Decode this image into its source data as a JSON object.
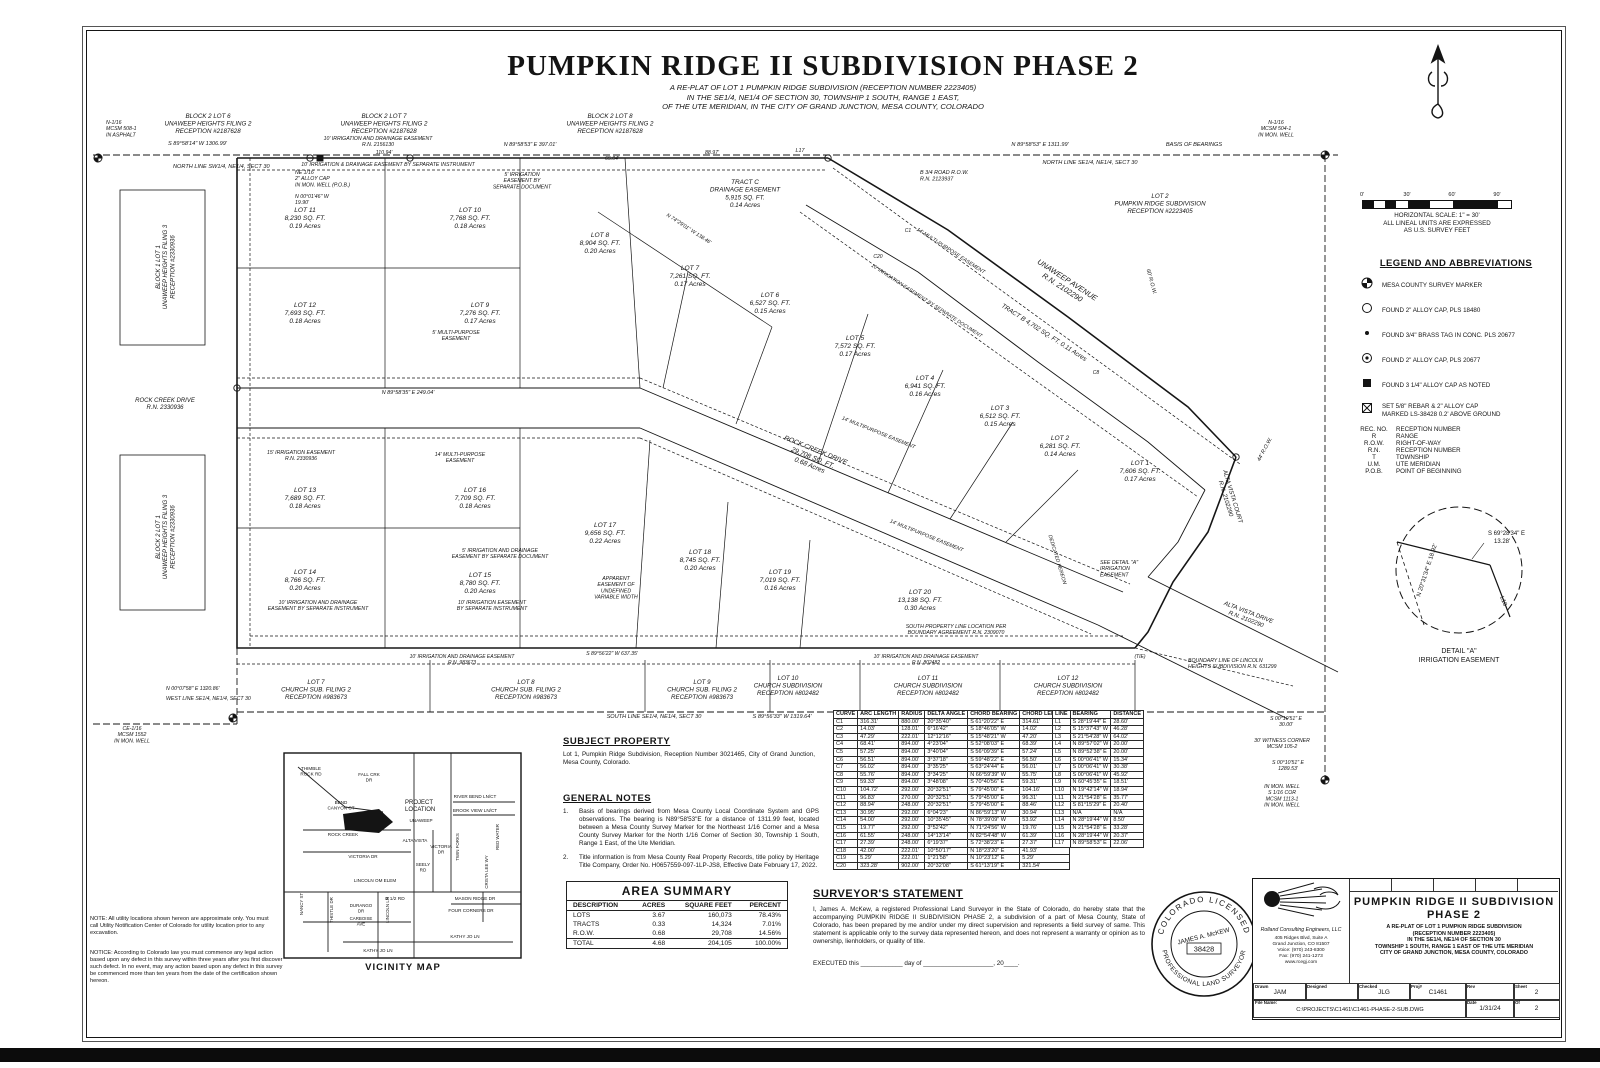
{
  "title": {
    "main": "PUMPKIN RIDGE II SUBDIVISION PHASE 2",
    "sub1": "A RE-PLAT OF LOT 1 PUMPKIN RIDGE SUBDIVISION (RECEPTION NUMBER 2223405)",
    "sub2": "IN THE SE1/4, NE1/4 OF SECTION 30, TOWNSHIP 1 SOUTH, RANGE 1 EAST,",
    "sub3": "OF THE UTE MERIDIAN, IN THE CITY OF GRAND JUNCTION, MESA COUNTY, COLORADO"
  },
  "scale": {
    "ticks": [
      "0'",
      "30'",
      "60'",
      "90'"
    ],
    "cap1": "HORIZONTAL SCALE: 1\" = 30'",
    "cap2": "ALL LINEAL UNITS ARE EXPRESSED",
    "cap3": "AS U.S. SURVEY FEET"
  },
  "legend": {
    "heading": "LEGEND AND ABBREVIATIONS",
    "symbols": [
      {
        "sym": "mcsm",
        "label": "MESA COUNTY SURVEY MARKER"
      },
      {
        "sym": "circle",
        "label": "FOUND 2\" ALLOY CAP, PLS 18480"
      },
      {
        "sym": "dot",
        "label": "FOUND 3/4\" BRASS TAG IN CONC. PLS 20677"
      },
      {
        "sym": "circle-dot",
        "label": "FOUND 2\" ALLOY CAP, PLS 20677"
      },
      {
        "sym": "square",
        "label": "FOUND 3 1/4\" ALLOY CAP AS NOTED"
      },
      {
        "sym": "boxx",
        "label": "SET 5/8\" REBAR & 2\" ALLOY CAP\nMARKED LS-38428 0.2' ABOVE GROUND"
      }
    ],
    "abbreviations": [
      {
        "k": "REC. NO.",
        "v": "RECEPTION NUMBER"
      },
      {
        "k": "R",
        "v": "RANGE"
      },
      {
        "k": "R.O.W.",
        "v": "RIGHT-OF-WAY"
      },
      {
        "k": "R.N.",
        "v": "RECEPTION NUMBER"
      },
      {
        "k": "T",
        "v": "TOWNSHIP"
      },
      {
        "k": "U.M.",
        "v": "UTE MERIDIAN"
      },
      {
        "k": "P.O.B.",
        "v": "POINT OF BEGINNING"
      }
    ]
  },
  "detail_a": {
    "b1a": "S 69°28'34\" E",
    "b1b": "13.28'",
    "b2": "N 20°31'34\" E  18.92'",
    "tag": "L10",
    "cap1": "DETAIL \"A\"",
    "cap2": "IRRIGATION EASEMENT"
  },
  "plat": {
    "lots": [
      {
        "name": "LOT 1",
        "sqft": "7,606 SQ. FT.",
        "acres": "0.17 Acres"
      },
      {
        "name": "LOT 2",
        "sqft": "6,281 SQ. FT.",
        "acres": "0.14 Acres"
      },
      {
        "name": "LOT 3",
        "sqft": "6,512 SQ. FT.",
        "acres": "0.15 Acres"
      },
      {
        "name": "LOT 4",
        "sqft": "6,941 SQ. FT.",
        "acres": "0.16 Acres"
      },
      {
        "name": "LOT 5",
        "sqft": "7,572 SQ. FT.",
        "acres": "0.17 Acres"
      },
      {
        "name": "LOT 6",
        "sqft": "6,527 SQ. FT.",
        "acres": "0.15 Acres"
      },
      {
        "name": "LOT 7",
        "sqft": "7,261 SQ. FT.",
        "acres": "0.17 Acres"
      },
      {
        "name": "LOT 8",
        "sqft": "8,904 SQ. FT.",
        "acres": "0.20 Acres"
      },
      {
        "name": "LOT 9",
        "sqft": "7,276 SQ. FT.",
        "acres": "0.17 Acres"
      },
      {
        "name": "LOT 10",
        "sqft": "7,768 SQ. FT.",
        "acres": "0.18 Acres"
      },
      {
        "name": "LOT 11",
        "sqft": "8,230 SQ. FT.",
        "acres": "0.19 Acres"
      },
      {
        "name": "LOT 12",
        "sqft": "7,693 SQ. FT.",
        "acres": "0.18 Acres"
      },
      {
        "name": "LOT 13",
        "sqft": "7,689 SQ. FT.",
        "acres": "0.18 Acres"
      },
      {
        "name": "LOT 14",
        "sqft": "8,766 SQ. FT.",
        "acres": "0.20 Acres"
      },
      {
        "name": "LOT 15",
        "sqft": "8,780 SQ. FT.",
        "acres": "0.20 Acres"
      },
      {
        "name": "LOT 16",
        "sqft": "7,709 SQ. FT.",
        "acres": "0.18 Acres"
      },
      {
        "name": "LOT 17",
        "sqft": "9,656 SQ. FT.",
        "acres": "0.22 Acres"
      },
      {
        "name": "LOT 18",
        "sqft": "8,745 SQ. FT.",
        "acres": "0.20 Acres"
      },
      {
        "name": "LOT 19",
        "sqft": "7,019 SQ. FT.",
        "acres": "0.16 Acres"
      },
      {
        "name": "LOT 20",
        "sqft": "13,138 SQ. FT.",
        "acres": "0.30 Acres"
      }
    ],
    "annotations": [
      "N-1/16\nMCSM 508-1\nIN ASPHALT",
      "S 89°58'14\" W  1306.99'",
      "NORTH LINE SW1/4, NE1/4, SECT 30",
      "BLOCK 2 LOT 6\nUNAWEEP HEIGHTS FILING 2\nRECEPTION #2187628",
      "BLOCK 2 LOT 7\nUNAWEEP HEIGHTS FILING 2\nRECEPTION #2187628",
      "BLOCK 2 LOT 8\nUNAWEEP HEIGHTS FILING 2\nRECEPTION #2187628",
      "10' IRRIGATION AND DRAINAGE EASEMENT\nR.N. 2156130",
      "N 89°58'53\" E  397.01'",
      "10' IRRIGATION & DRAINAGE EASEMENT  BY SEPARATE INSTRUMENT",
      "NE 1/16\n2\" ALLOY CAP\nIN MON. WELL (P.O.B.)",
      "N 00°01'46\" W\n19.90'",
      "N 89°58'53\" E  1311.99'",
      "BASIS OF BEARINGS",
      "NORTH LINE SE1/4, NE1/4, SECT 30",
      "N-1/16\nMCSM 504-1\nIN MON. WELL",
      "B 3/4 ROAD R.O.W.\nR.N. 2123937",
      "LOT 2\nPUMPKIN RIDGE SUBDIVISION\nRECEPTION #2223405",
      "UNAWEEP AVENUE\nR.N. 2102290",
      "TRACT B    4,702 SQ. FT.    0.11 Acres",
      "60' R.O.W.",
      "14' MULTI-PURPOSE EASEMENT",
      "10' IRRIGATION EASEMENT  BY SEPARATE DOCUMENT",
      "ROCK CREEK DRIVE\nR.N. 2330936",
      "N 89°58'35\" E  249.04'",
      "ROCK CREEK DRIVE\n29,708 SQ. FT.\n0.68 Acres",
      "ALTA VISTA COURT\nR.N. 2102290",
      "ALTA VISTA DRIVE\nR.N. 2102290",
      "14' MULTIPURPOSE EASEMENT",
      "14' MULTIPURPOSE EASEMENT",
      "15' IRRIGATION EASEMENT\nR.N. 2330936",
      "14' MULTI-PURPOSE\nEASEMENT",
      "5' MULTI-PURPOSE\nEASEMENT",
      "5' IRRIGATION\nEASEMENT BY\nSEPARATE DOCUMENT",
      "5' IRRIGATION AND DRAINAGE\nEASEMENT BY SEPARATE DOCUMENT",
      "10' IRRIGATION AND DRAINAGE\nEASEMENT BY SEPARATE INSTRUMENT",
      "10' IRRIGATION EASEMENT\nBY SEPARATE INSTRUMENT",
      "APPARENT\nEASEMENT OF\nUNDEFINED\nVARIABLE WIDTH",
      "SOUTH PROPERTY LINE LOCATION PER\nBOUNDARY AGREEMENT R.N. 2309070",
      "BOUNDARY LINE OF LINCOLN\nHEIGHTS SUBDIVISION R.N. 631299",
      "SEE DETAIL \"A\"\nIRRIGATION\nEASEMENT",
      "DEDICATED HEREON",
      "44' R.O.W.",
      "(TIE)",
      "L17",
      "C1",
      "C20",
      "C8",
      "LOT 7\nCHURCH SUB. FILING 2\nRECEPTION #983673",
      "LOT 8\nCHURCH SUB. FILING 2\nRECEPTION #983673",
      "LOT 9\nCHURCH SUB. FILING 2\nRECEPTION #983673",
      "LOT 10\nCHURCH SUBDIVISION\nRECEPTION #802482",
      "LOT 11\nCHURCH SUBDIVISION\nRECEPTION #802482",
      "LOT 12\nCHURCH SUBDIVISION\nRECEPTION #802482",
      "10' IRRIGATION AND DRAINAGE EASEMENT\nR.N. 983673",
      "S 89°56'22\" W  637.35'",
      "10' IRRIGATION AND DRAINAGE EASEMENT\nR.N. 802482",
      "SOUTH LINE SE1/4, NE1/4, SECT 30",
      "S 89°56'33\" W  1319.64'",
      "CE-1/16\nMCSM 1552\nIN MON. WELL",
      "N 00°07'58\" E  1320.86'",
      "WEST LINE SE1/4, NE1/4, SECT 30",
      "S 00°10'51\" E\n30.00'",
      "30' WITNESS CORNER\nMCSM 105-2",
      "S 00°10'51\" E\n1289.53'",
      "IN MON. WELL\nS 1/16 COR\nMCSM 1113-1\nIN MON. WELL",
      "BLOCK 1 LOT 1\nUNAWEEP HEIGHTS FILING 3\nRECEPTION #2330936",
      "BLOCK 2 LOT 1\nUNAWEEP HEIGHTS FILING 3\nRECEPTION #2330936",
      "TRACT C\nDRAINAGE EASEMENT\n5,915 SQ. FT.\n0.14 Acres",
      "N 74°29'01\" W  138.46'",
      "110.94'",
      "65.04'",
      "88.97'"
    ]
  },
  "subject": {
    "heading": "SUBJECT PROPERTY",
    "body": "Lot 1, Pumpkin Ridge Subdivision, Reception Number 3021465, City of Grand Junction, Mesa County, Colorado."
  },
  "general_notes": {
    "heading": "GENERAL NOTES",
    "items": [
      {
        "no": "1.",
        "text": "Basis of bearings derived from Mesa County Local Coordinate System and GPS observations.  The bearing is N89°58'53\"E for a distance of 1311.99 feet, located between a Mesa County Survey Marker for the Northeast 1/16 Corner and a Mesa County Survey Marker for the North 1/16 Corner of Section 30, Township 1 South, Range 1 East, of the Ute Meridian."
      },
      {
        "no": "2.",
        "text": "Title information is from Mesa County Real Property Records, title policy by Heritage Title Company, Order No. H0657559-097-1LP-JS8, Effective Date February 17, 2022."
      }
    ]
  },
  "area_summary": {
    "title": "AREA SUMMARY",
    "headers": [
      "DESCRIPTION",
      "ACRES",
      "SQUARE FEET",
      "PERCENT"
    ],
    "rows": [
      [
        "LOTS",
        "3.67",
        "160,073",
        "78.43%"
      ],
      [
        "TRACTS",
        "0.33",
        "14,324",
        "7.01%"
      ],
      [
        "R.O.W.",
        "0.68",
        "29,708",
        "14.56%"
      ]
    ],
    "total": [
      "TOTAL",
      "4.68",
      "204,105",
      "100.00%"
    ]
  },
  "surveyor": {
    "heading": "SURVEYOR'S STATEMENT",
    "body": "I, James A. McKew, a registered Professional Land Surveyor in the State of Colorado, do hereby state that the accompanying PUMPKIN RIDGE II SUBDIVISION PHASE 2, a subdivision of a part of Mesa County, State of Colorado, has been prepared by me and/or under my direct supervision and represents a field survey of same.  This statement is applicable only to the survey data represented hereon,  and does not represent a warranty or opinion as to ownership, lienholders, or quality of title.",
    "executed": "EXECUTED this ____________ day of ____________________, 20____."
  },
  "seal": {
    "top": "COLORADO LICENSED",
    "bottom": "PROFESSIONAL LAND SURVEYOR",
    "name": "JAMES A. McKEW",
    "number": "38428"
  },
  "curve_table": {
    "headers": [
      "CURVE",
      "ARC LENGTH",
      "RADIUS",
      "DELTA ANGLE",
      "CHORD BEARING",
      "CHORD LENGTH"
    ],
    "rows": [
      [
        "C1",
        "316.31'",
        "880.00'",
        "20°35'40\"",
        "S 61°20'22\" E",
        "314.61'"
      ],
      [
        "C2",
        "14.03'",
        "128.01'",
        "6°16'42\"",
        "S 18°46'05\" W",
        "14.02'"
      ],
      [
        "C3",
        "47.29'",
        "222.01'",
        "12°12'16\"",
        "S 15°48'21\" W",
        "47.20'"
      ],
      [
        "C4",
        "68.41'",
        "894.00'",
        "4°23'04\"",
        "S 52°08'03\" E",
        "68.39'"
      ],
      [
        "C5",
        "57.25'",
        "894.00'",
        "3°40'04\"",
        "S 56°09'39\" E",
        "57.24'"
      ],
      [
        "C6",
        "56.51'",
        "894.00'",
        "3°37'18\"",
        "S 59°48'22\" E",
        "56.50'"
      ],
      [
        "C7",
        "56.02'",
        "894.00'",
        "3°35'25\"",
        "S 63°24'44\" E",
        "56.01'"
      ],
      [
        "C8",
        "55.76'",
        "894.00'",
        "3°34'25\"",
        "N 66°59'39\" W",
        "55.75'"
      ],
      [
        "C9",
        "59.33'",
        "894.00'",
        "3°48'08\"",
        "S 70°40'56\" E",
        "59.31'"
      ],
      [
        "C10",
        "104.72'",
        "292.00'",
        "20°32'51\"",
        "S 79°45'00\" E",
        "104.16'"
      ],
      [
        "C11",
        "96.83'",
        "270.00'",
        "20°32'51\"",
        "S 79°45'00\" E",
        "96.31'"
      ],
      [
        "C12",
        "88.94'",
        "248.00'",
        "20°32'51\"",
        "S 79°45'00\" E",
        "88.46'"
      ],
      [
        "C13",
        "30.95'",
        "292.00'",
        "6°04'23\"",
        "N 86°59'13\" W",
        "30.94'"
      ],
      [
        "C14",
        "54.00'",
        "292.00'",
        "10°35'45\"",
        "N 78°39'09\" W",
        "53.92'"
      ],
      [
        "C15",
        "19.77'",
        "292.00'",
        "3°52'42\"",
        "N 71°24'56\" W",
        "19.76'"
      ],
      [
        "C16",
        "61.55'",
        "248.00'",
        "14°13'14\"",
        "N 82°54'48\" W",
        "61.39'"
      ],
      [
        "C17",
        "27.39'",
        "248.00'",
        "6°19'37\"",
        "S 72°38'23\" E",
        "27.37'"
      ],
      [
        "C18",
        "42.00'",
        "222.01'",
        "10°50'17\"",
        "N 18°23'20\" E",
        "41.93'"
      ],
      [
        "C19",
        "5.29'",
        "222.01'",
        "1°21'58\"",
        "N 10°23'12\" E",
        "5.29'"
      ],
      [
        "C20",
        "323.28'",
        "902.00'",
        "20°32'08\"",
        "S 61°13'19\" E",
        "321.54'"
      ]
    ]
  },
  "line_table": {
    "headers": [
      "LINE",
      "BEARING",
      "DISTANCE"
    ],
    "rows": [
      [
        "L1",
        "S 28°19'44\" E",
        "28.60'"
      ],
      [
        "L2",
        "S 15°37'43\" W",
        "46.28'"
      ],
      [
        "L3",
        "S 21°54'28\" W",
        "64.02'"
      ],
      [
        "L4",
        "N 89°57'02\" W",
        "20.00'"
      ],
      [
        "L5",
        "N 89°52'38\" E",
        "20.00'"
      ],
      [
        "L6",
        "S 00°06'41\" W",
        "15.34'"
      ],
      [
        "L7",
        "S 00°06'41\" W",
        "30.38'"
      ],
      [
        "L8",
        "S 00°06'41\" W",
        "45.92'"
      ],
      [
        "L9",
        "N 60°45'35\" E",
        "18.51'"
      ],
      [
        "L10",
        "N 19°42'14\" W",
        "18.94'"
      ],
      [
        "L11",
        "N 21°54'28\" E",
        "35.77'"
      ],
      [
        "L12",
        "S 81°15'29\" E",
        "20.40'"
      ],
      [
        "L13",
        "N/A",
        "N/A"
      ],
      [
        "L14",
        "N 28°19'44\" W",
        "8.50'"
      ],
      [
        "L15",
        "N 21°54'28\" E",
        "33.28'"
      ],
      [
        "L16",
        "N 28°19'44\" W",
        "20.37'"
      ],
      [
        "L17",
        "N 89°58'53\" E",
        "22.06'"
      ]
    ]
  },
  "vicinity": {
    "caption": "VICINITY MAP",
    "labels": [
      "THIMBLE\nROCK RD",
      "FALL CRK\nDR",
      "BEND\nCANYON CT",
      "PROJECT\nLOCATION",
      "UNAWEEP",
      "ROCK CREEK",
      "ALTA VISTA",
      "VICTORIA DR",
      "VICTORIA\nDR",
      "SEELY\nRD",
      "LINCOLN OM ELEM",
      "B 1/2 RD",
      "NANCY ST",
      "THISTLE DR",
      "DURANGO\nDR",
      "CARBOISE\nAVE",
      "LINCOLN LN",
      "KATHY JO LN",
      "RIVER BEND LN/CT",
      "BROOK VIEW LN/CT",
      "TWIN FORKS",
      "RED WATER",
      "CRISTA LEE WY",
      "MASON RIDGE DR",
      "FOUR CORNERS DR",
      "KATHY JO LN"
    ]
  },
  "notes_left": {
    "note": "NOTE: All utility locations shown hereon are approximate only.  You must call Utility Notification Center of Colorado for utility location prior to any excavation.",
    "notice": "NOTICE: According to Colorado law you must commence any legal action based upon any defect in this survey within three years after you first discover such defect.  In no event, may any action based upon any defect in this survey be commenced more than ten years from the date of the certification shown hereon."
  },
  "title_block": {
    "company": "Rolland Consulting Engineers, LLC",
    "addr1": "405 Ridges Blvd, Suite A",
    "addr2": "Grand Junction, CO 81507",
    "addr3": "Voice: (970) 243-8300",
    "addr4": "Fax: (970) 241-1273",
    "addr5": "www.rcegj.com",
    "title1": "PUMPKIN RIDGE II SUBDIVISION",
    "title2": "PHASE 2",
    "sub1": "A RE-PLAT OF LOT 1 PUMPKIN RIDGE SUBDIVISION",
    "sub2": "(RECEPTION NUMBER 2223405)",
    "sub3": "IN THE SE1/4, NE1/4 OF SECTION 30",
    "sub4": "TOWNSHIP 1 SOUTH, RANGE 1 EAST OF THE UTE MERIDIAN",
    "sub5": "CITY OF GRAND JUNCTION, MESA COUNTY, COLORADO",
    "f_drawn_l": "Drawn",
    "f_drawn": "JAM",
    "f_designed_l": "Designed",
    "f_designed": "",
    "f_checked_l": "Checked",
    "f_checked": "JLG",
    "f_proj_l": "Proj#",
    "f_proj": "C1461",
    "f_rev_l": "Rev",
    "f_rev": "",
    "f_sheet_l": "Sheet",
    "f_sheet": "2",
    "f_file_l": "File Name:",
    "f_file": "C:\\PROJECTS\\C1461\\C1461-PHASE-2-SUB.DWG",
    "f_date_l": "Date",
    "f_date": "1/31/24",
    "f_of_l": "Of",
    "f_of": "2"
  }
}
